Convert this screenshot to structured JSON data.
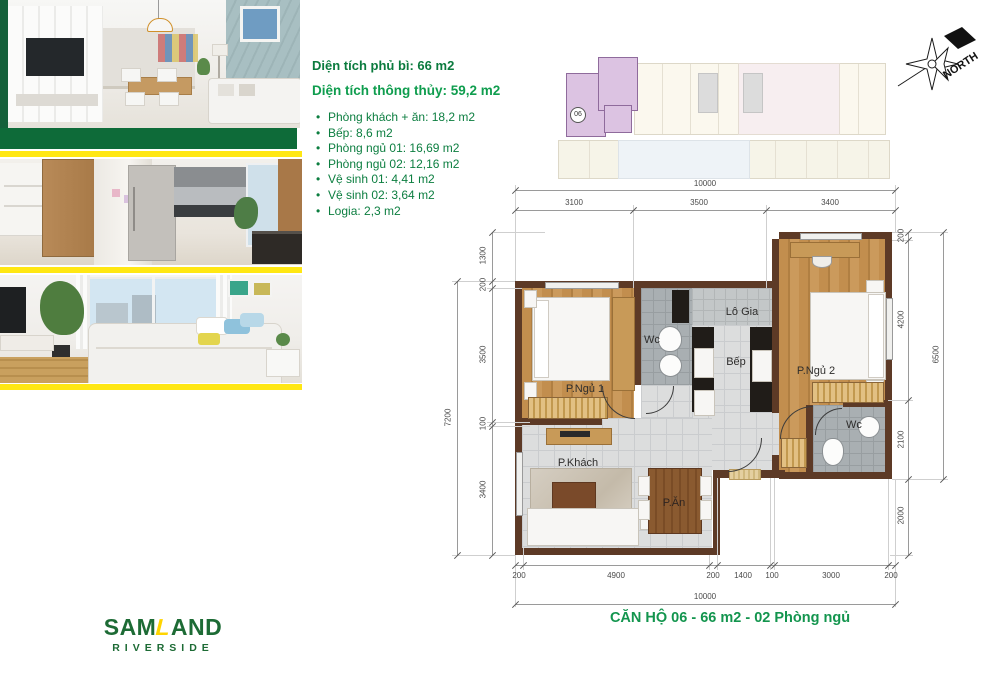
{
  "info": {
    "title1": "Diện tích phủ bì: 66 m2",
    "title2": "Diện tích thông thủy: 59,2 m2",
    "items": [
      "Phòng khách + ăn: 18,2 m2",
      "Bếp: 8,6 m2",
      "Phòng ngủ 01: 16,69 m2",
      "Phòng ngủ 02: 12,16 m2",
      "Vệ sinh 01: 4,41 m2",
      "Vệ sinh 02: 3,64 m2",
      "Logia: 2,3 m2"
    ]
  },
  "keyplan": {
    "unit_number": "06"
  },
  "north": {
    "label": "NORTH"
  },
  "plan": {
    "rooms": {
      "bedroom1": "P.Ngủ 1",
      "bedroom2": "P.Ngủ 2",
      "wc1": "Wc",
      "wc2": "Wc",
      "kitchen": "Bếp",
      "loggia": "Lô Gia",
      "living": "P.Khách",
      "dining": "P.Ăn"
    },
    "dimensions": {
      "top_overall": "10000",
      "top_segments": [
        "3100",
        "3500",
        "3400"
      ],
      "left_overall": "7200",
      "left_segments": [
        "1300",
        "200",
        "3500",
        "100",
        "3400"
      ],
      "right_overall": "6500",
      "right_segments": [
        "200",
        "4200",
        "2100",
        "2000"
      ],
      "bottom_overall": "10000",
      "bottom_segments": [
        "200",
        "4900",
        "200",
        "1400",
        "100",
        "3000",
        "200"
      ]
    }
  },
  "caption": "CĂN HỘ 06 - 66 m2 - 02 Phòng ngủ",
  "logo": {
    "part1": "SAM",
    "part2": "L",
    "part3": "AND",
    "line2": "RIVERSIDE"
  },
  "colors": {
    "accent_green_dark": "#0b7b3e",
    "accent_green": "#13954e",
    "bar_green": "#0e6b39",
    "bar_yellow": "#ffe713",
    "wall_brown": "#5d3a26",
    "keyplan_highlight": "#dcc3e2"
  }
}
